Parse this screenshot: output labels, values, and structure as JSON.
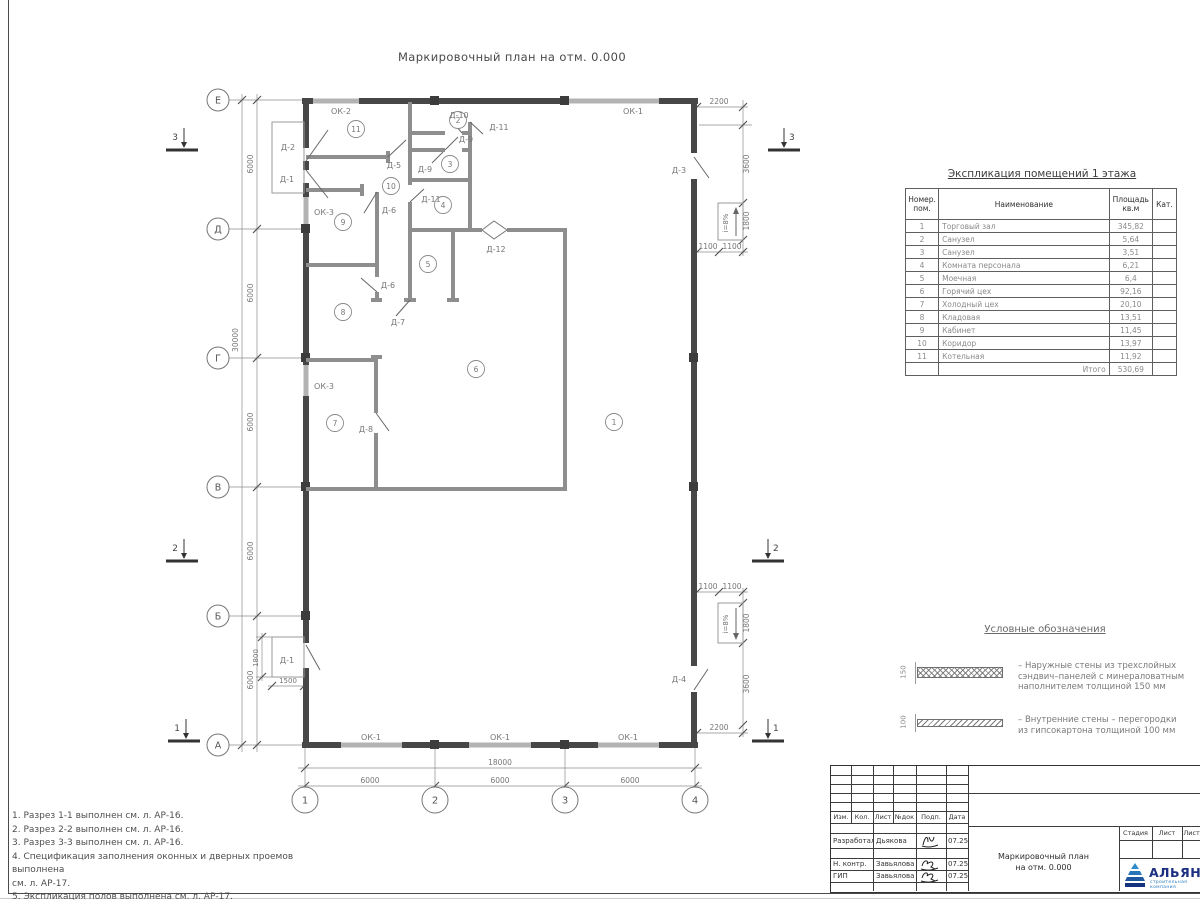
{
  "drawing_title": "Маркировочный план на отм. 0.000",
  "axes": {
    "rows": [
      "Е",
      "Д",
      "Г",
      "В",
      "Б",
      "А"
    ],
    "cols": [
      "1",
      "2",
      "3",
      "4"
    ]
  },
  "sections": {
    "s1": "1",
    "s2": "2",
    "s3": "3"
  },
  "dims": {
    "d30000": "30000",
    "d18000": "18000",
    "d6000": "6000",
    "d2200": "2200",
    "d3600": "3600",
    "d1800": "1800",
    "d1100": "1100",
    "d1500": "1500",
    "slope": "i=8%"
  },
  "marks": {
    "d1": "Д-1",
    "d2": "Д-2",
    "d3": "Д-3",
    "d4": "Д-4",
    "d5": "Д-5",
    "d6": "Д-6",
    "d7": "Д-7",
    "d8": "Д-8",
    "d9": "Д-9",
    "d10": "Д-10",
    "d11": "Д-11",
    "d12": "Д-12",
    "ok1": "ОК-1",
    "ok2": "ОК-2",
    "ok3": "ОК-3"
  },
  "rooms": [
    "1",
    "2",
    "3",
    "4",
    "5",
    "6",
    "7",
    "8",
    "9",
    "10",
    "11"
  ],
  "schedule": {
    "title": "Экспликация помещений 1 этажа",
    "headers": [
      "Номер. пом.",
      "Наименование",
      "Площадь кв.м",
      "Кат."
    ],
    "rows": [
      {
        "n": "1",
        "name": "Торговый зал",
        "area": "345,82"
      },
      {
        "n": "2",
        "name": "Санузел",
        "area": "5,64"
      },
      {
        "n": "3",
        "name": "Санузел",
        "area": "3,51"
      },
      {
        "n": "4",
        "name": "Комната персонала",
        "area": "6,21"
      },
      {
        "n": "5",
        "name": "Моечная",
        "area": "6,4"
      },
      {
        "n": "6",
        "name": "Горячий цех",
        "area": "92,16"
      },
      {
        "n": "7",
        "name": "Холодный цех",
        "area": "20,10"
      },
      {
        "n": "8",
        "name": "Кладовая",
        "area": "13,51"
      },
      {
        "n": "9",
        "name": "Кабинет",
        "area": "11,45"
      },
      {
        "n": "10",
        "name": "Коридор",
        "area": "13,97"
      },
      {
        "n": "11",
        "name": "Котельная",
        "area": "11,92"
      }
    ],
    "total_label": "Итого",
    "total": "530,69"
  },
  "legend": {
    "title": "Условные обозначения",
    "wall150": {
      "dim": "150",
      "line1": "– Наружные стены из трехслойных",
      "line2": "сэндвич–панелей с минераловатным",
      "line3": "наполнителем толщиной 150 мм"
    },
    "wall100": {
      "dim": "100",
      "line1": "– Внутренние стены – перегородки",
      "line2": "из гипсокартона толщиной 100 мм"
    }
  },
  "notes": {
    "n1": "1. Разрез 1-1 выполнен см. л. АР-16.",
    "n2": "2. Разрез 2-2 выполнен см. л. АР-16.",
    "n3": "3. Разрез 3-3 выполнен см. л. АР-16.",
    "n4": "4. Спецификация заполнения оконных и дверных проемов выполнена",
    "n5": "см. л. АР-17.",
    "n6": "5. Экспликация полов выполнена см. л. АР-17."
  },
  "stamp": {
    "cols": [
      "Изм.",
      "Кол.",
      "Лист",
      "№док",
      "Подп.",
      "Дата"
    ],
    "row_developed": {
      "role": "Разработал",
      "name": "Дьякова",
      "date": "07.25"
    },
    "row_ncontr": {
      "role": "Н. контр.",
      "name": "Завьялова",
      "date": "07.25"
    },
    "row_gip": {
      "role": "ГИП",
      "name": "Завьялова",
      "date": "07.25"
    },
    "title_line1": "Маркировочный план",
    "title_line2": "на отм. 0.000",
    "stage": "Стадия",
    "sheet": "Лист",
    "sheets": "Листов",
    "logo": "АЛЬЯНС",
    "logo_sub": "строительная компания"
  }
}
